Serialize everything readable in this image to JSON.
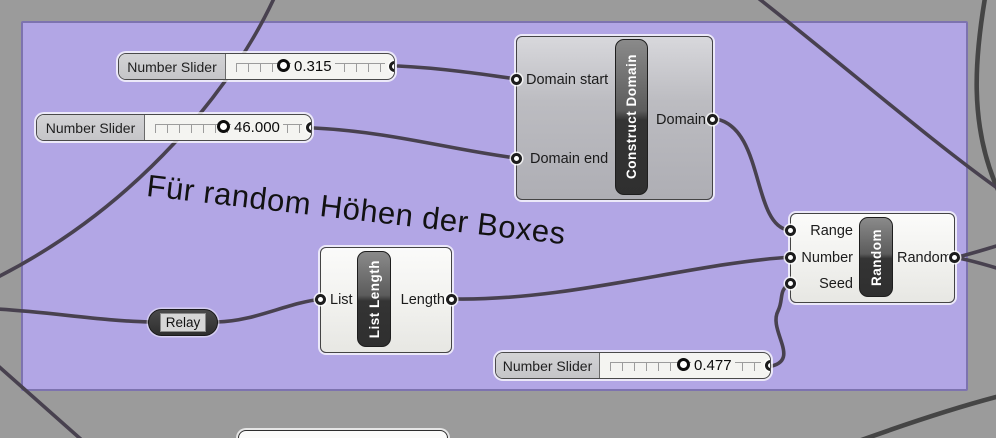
{
  "colors": {
    "canvas_grey": "#9b9b9b",
    "group_fill": "#b2a6e5",
    "group_border": "#7d73af",
    "wire": "#48414f"
  },
  "note": {
    "text": "Für random Höhen der Boxes"
  },
  "sliders": [
    {
      "label": "Number Slider",
      "value": "0.315"
    },
    {
      "label": "Number Slider",
      "value": "46.000"
    },
    {
      "label": "Number Slider",
      "value": "0.477"
    }
  ],
  "construct_domain": {
    "name": "Construct Domain",
    "input_1": "Domain start",
    "input_2": "Domain end",
    "output_1": "Domain"
  },
  "list_length": {
    "name": "List Length",
    "input_1": "List",
    "output_1": "Length"
  },
  "random": {
    "name": "Random",
    "input_1": "Range",
    "input_2": "Number",
    "input_3": "Seed",
    "output_1": "Random"
  },
  "relay": {
    "label": "Relay"
  }
}
